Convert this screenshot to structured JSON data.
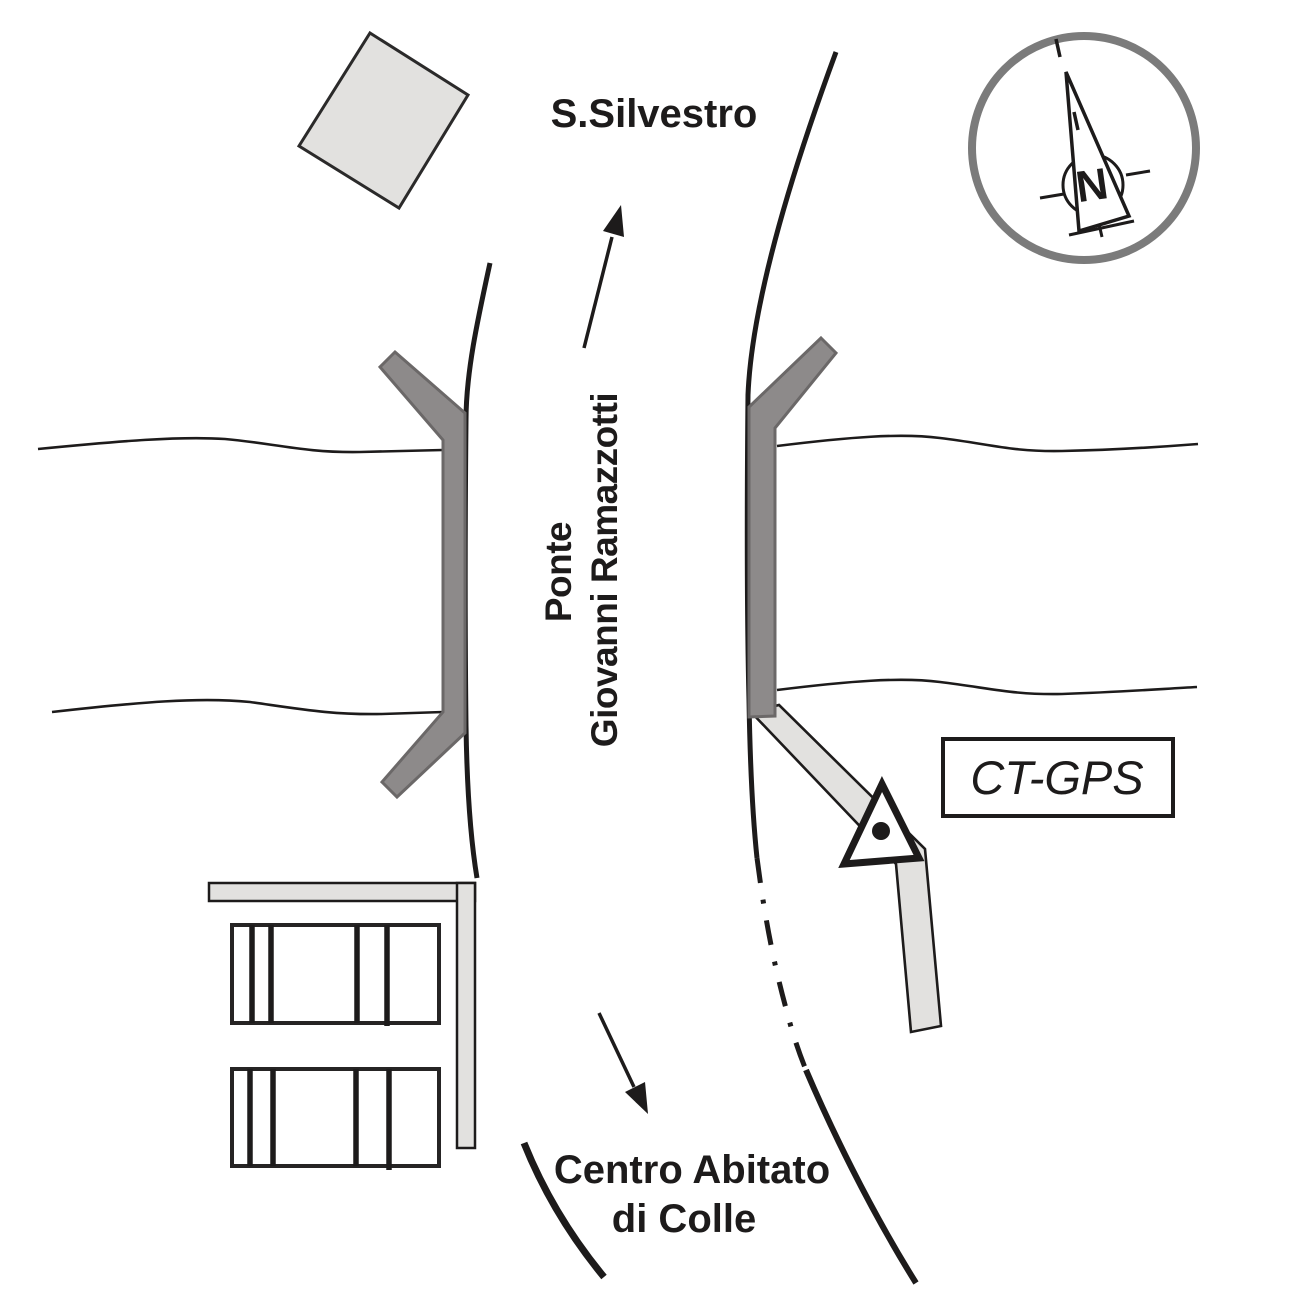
{
  "labels": {
    "destination_north": "S.Silvestro",
    "bridge_name_line1": "Ponte",
    "bridge_name_line2": "Giovanni Ramazzotti",
    "station_label": "CT-GPS",
    "destination_south_line1": "Centro Abitato",
    "destination_south_line2": "di Colle",
    "compass_north": "N"
  },
  "colors": {
    "ink": "#1d1b1b",
    "parapet_fill": "#8d8a8a",
    "parapet_stroke": "#6b6868",
    "surface_fill": "#e2e1df",
    "surface_stroke": "#1d1b1b",
    "square_fill": "#e2e1df",
    "square_stroke": "#2b2a2a",
    "compass_ring": "#7b7b7b",
    "background": "#ffffff"
  }
}
